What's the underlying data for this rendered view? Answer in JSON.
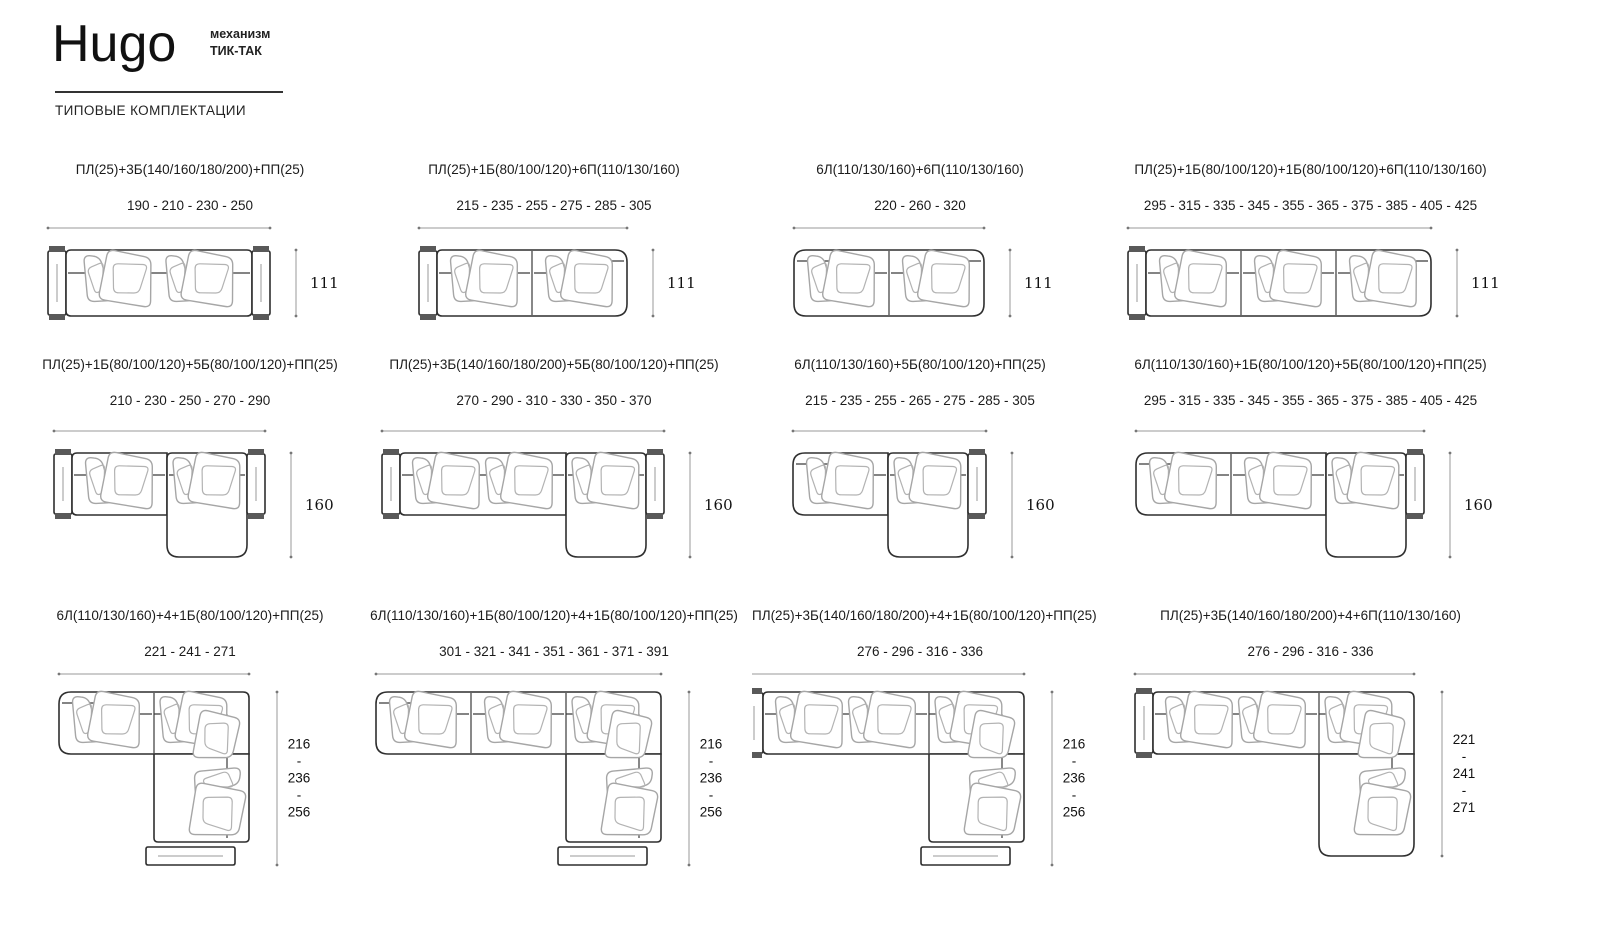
{
  "header": {
    "brand": "Hugo",
    "mechanism": "механизм\nТИК-ТАК",
    "subtitle": "ТИПОВЫЕ КОМПЛЕКТАЦИИ"
  },
  "cells": [
    {
      "config": "ПЛ(25)+3Б(140/160/180/200)+ПП(25)",
      "widths": "190 - 210 - 230 - 250",
      "height": "111",
      "diagram": {
        "type": "straight",
        "left": "arm",
        "right": "arm",
        "mods": [
          2
        ]
      }
    },
    {
      "config": "ПЛ(25)+1Б(80/100/120)+6П(110/130/160)",
      "widths": "215 - 235 - 255 - 275 - 285 - 305",
      "height": "111",
      "diagram": {
        "type": "straight",
        "left": "arm",
        "right": "open",
        "mods": [
          1,
          1
        ]
      }
    },
    {
      "config": "6Л(110/130/160)+6П(110/130/160)",
      "widths": "220 - 260 - 320",
      "height": "111",
      "diagram": {
        "type": "straight",
        "left": "open",
        "right": "open",
        "mods": [
          1,
          1
        ]
      }
    },
    {
      "config": "ПЛ(25)+1Б(80/100/120)+1Б(80/100/120)+6П(110/130/160)",
      "widths": "295 - 315 - 335 - 345 - 355 - 365 - 375 - 385 - 405 - 425",
      "height": "111",
      "diagram": {
        "type": "straight",
        "left": "arm",
        "right": "open",
        "mods": [
          1,
          1,
          1
        ]
      }
    },
    {
      "config": "ПЛ(25)+1Б(80/100/120)+5Б(80/100/120)+ПП(25)",
      "widths": "210 - 230 - 250 - 270 - 290",
      "height": "160",
      "diagram": {
        "type": "chaise",
        "left": "arm",
        "right": "arm",
        "mods": [
          1
        ]
      }
    },
    {
      "config": "ПЛ(25)+3Б(140/160/180/200)+5Б(80/100/120)+ПП(25)",
      "widths": "270 - 290 - 310 - 330 - 350 - 370",
      "height": "160",
      "diagram": {
        "type": "chaise",
        "left": "arm",
        "right": "arm",
        "mods": [
          2
        ]
      }
    },
    {
      "config": "6Л(110/130/160)+5Б(80/100/120)+ПП(25)",
      "widths": "215 - 235 - 255 - 265 - 275 - 285 - 305",
      "height": "160",
      "diagram": {
        "type": "chaise",
        "left": "open",
        "right": "arm",
        "mods": [
          1
        ]
      }
    },
    {
      "config": "6Л(110/130/160)+1Б(80/100/120)+5Б(80/100/120)+ПП(25)",
      "widths": "295 - 315 - 335 - 345 - 355 - 365 - 375 - 385 - 405 - 425",
      "height": "160",
      "diagram": {
        "type": "chaise",
        "left": "open",
        "right": "arm",
        "mods": [
          1,
          1
        ]
      }
    },
    {
      "config": "6Л(110/130/160)+4+1Б(80/100/120)+ПП(25)",
      "widths": "221 - 241 - 271",
      "height": "216\n-\n236\n-\n256",
      "diagram": {
        "type": "corner",
        "left": "open",
        "bottom": "pouf",
        "mods": [
          1
        ]
      }
    },
    {
      "config": "6Л(110/130/160)+1Б(80/100/120)+4+1Б(80/100/120)+ПП(25)",
      "widths": "301 - 321 - 341 - 351 - 361 - 371 - 391",
      "height": "216\n-\n236\n-\n256",
      "diagram": {
        "type": "corner",
        "left": "open",
        "bottom": "pouf",
        "mods": [
          1,
          1
        ]
      }
    },
    {
      "config": "ПЛ(25)+3Б(140/160/180/200)+4+1Б(80/100/120)+ПП(25)",
      "widths": "276 - 296 - 316 - 336",
      "height": "216\n-\n236\n-\n256",
      "diagram": {
        "type": "corner",
        "left": "arm",
        "bottom": "pouf",
        "mods": [
          2
        ]
      }
    },
    {
      "config": "ПЛ(25)+3Б(140/160/180/200)+4+6П(110/130/160)",
      "widths": "276 - 296 - 316 - 336",
      "height": "221\n-\n241\n-\n271",
      "diagram": {
        "type": "corner",
        "left": "arm",
        "bottom": "open",
        "mods": [
          2
        ]
      }
    }
  ]
}
